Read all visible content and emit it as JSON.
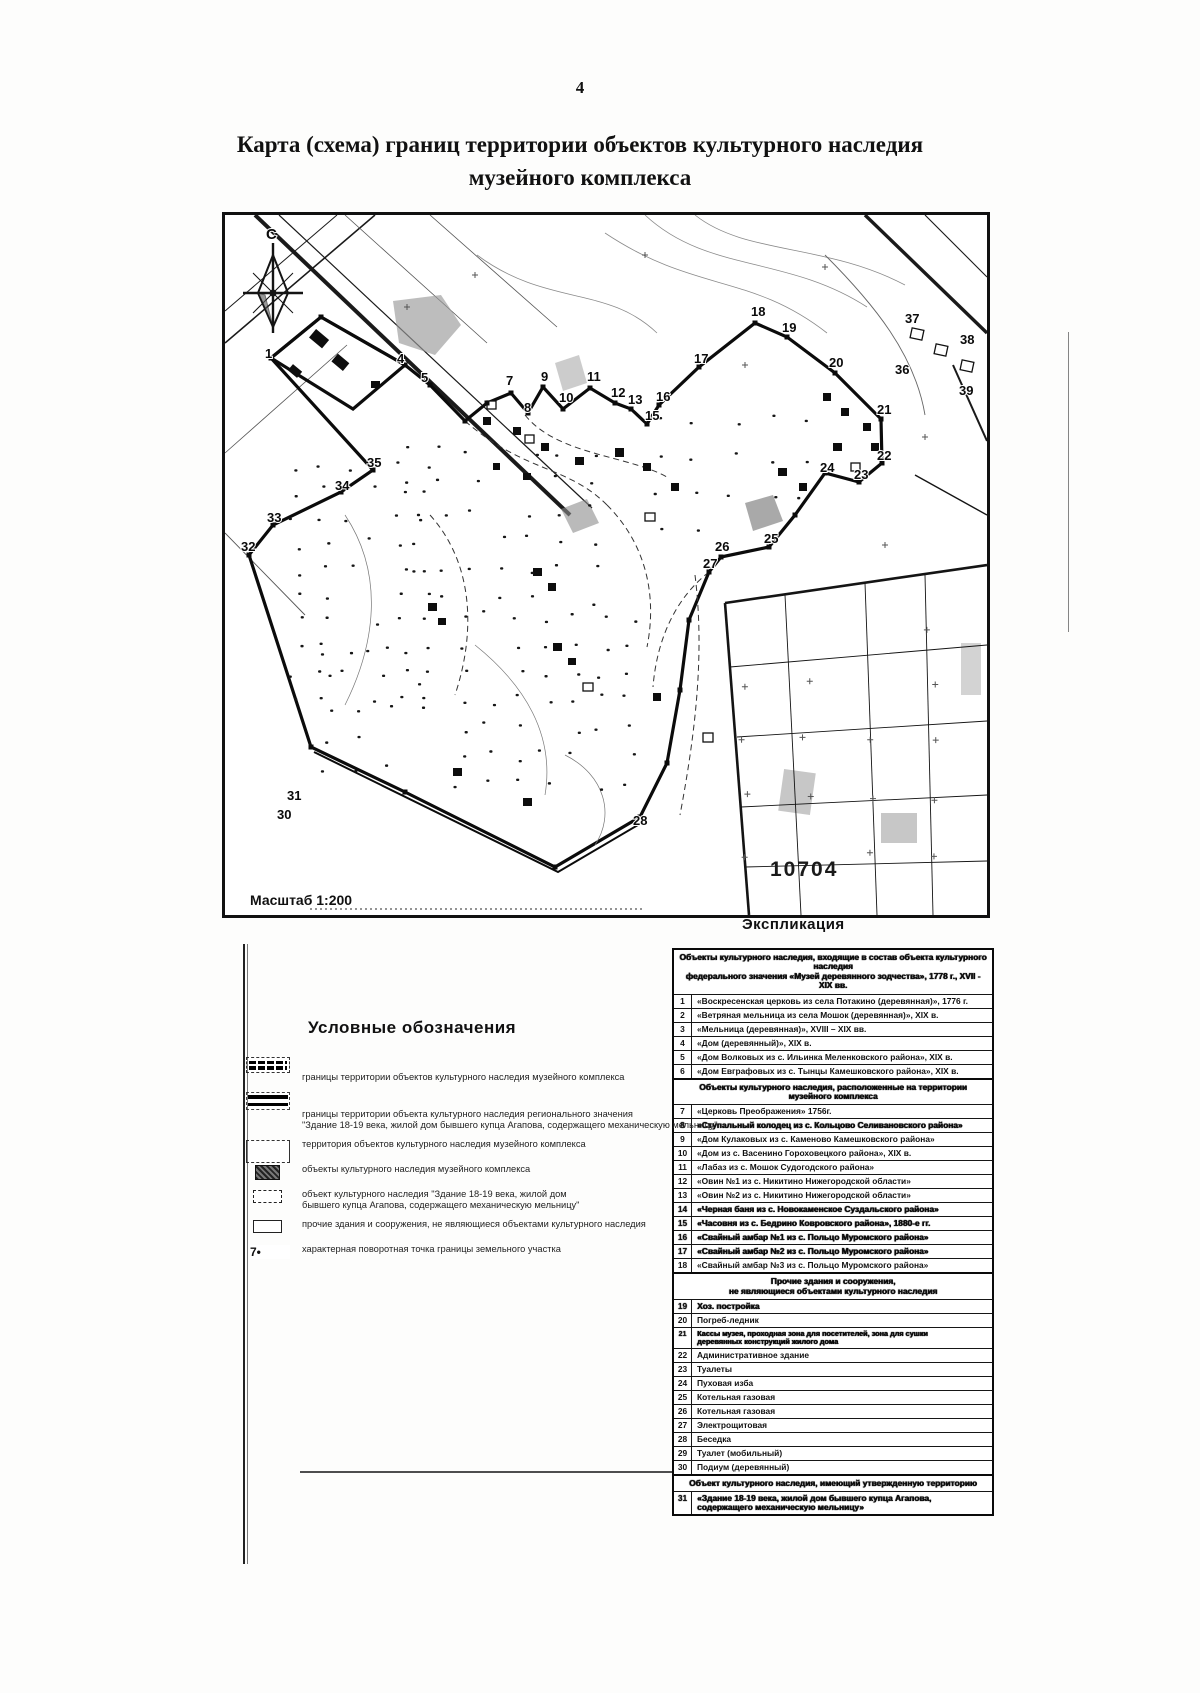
{
  "page": {
    "number": "4",
    "title": "Карта (схема) границ территории объектов культурного наследия\nмузейного комплекса"
  },
  "map": {
    "compass_label": "С",
    "scale_label": "Масштаб 1:200",
    "parcel_number": "10704",
    "points": [
      {
        "n": "1",
        "x": 40,
        "y": 143
      },
      {
        "n": "4",
        "x": 172,
        "y": 148
      },
      {
        "n": "5",
        "x": 196,
        "y": 167
      },
      {
        "n": "7",
        "x": 281,
        "y": 170
      },
      {
        "n": "8",
        "x": 299,
        "y": 197
      },
      {
        "n": "9",
        "x": 316,
        "y": 166
      },
      {
        "n": "10",
        "x": 334,
        "y": 187
      },
      {
        "n": "11",
        "x": 362,
        "y": 166
      },
      {
        "n": "12",
        "x": 386,
        "y": 182
      },
      {
        "n": "13",
        "x": 403,
        "y": 189
      },
      {
        "n": "15",
        "x": 420,
        "y": 205
      },
      {
        "n": "16",
        "x": 431,
        "y": 186
      },
      {
        "n": "17",
        "x": 469,
        "y": 148
      },
      {
        "n": "18",
        "x": 526,
        "y": 101
      },
      {
        "n": "19",
        "x": 557,
        "y": 117
      },
      {
        "n": "20",
        "x": 604,
        "y": 152
      },
      {
        "n": "21",
        "x": 652,
        "y": 199
      },
      {
        "n": "22",
        "x": 652,
        "y": 245
      },
      {
        "n": "23",
        "x": 629,
        "y": 264
      },
      {
        "n": "24",
        "x": 595,
        "y": 257
      },
      {
        "n": "25",
        "x": 539,
        "y": 328
      },
      {
        "n": "26",
        "x": 490,
        "y": 336
      },
      {
        "n": "27",
        "x": 478,
        "y": 353
      },
      {
        "n": "28",
        "x": 408,
        "y": 610
      },
      {
        "n": "30",
        "x": 52,
        "y": 604
      },
      {
        "n": "31",
        "x": 62,
        "y": 585
      },
      {
        "n": "32",
        "x": 16,
        "y": 336
      },
      {
        "n": "33",
        "x": 42,
        "y": 307
      },
      {
        "n": "34",
        "x": 110,
        "y": 275
      },
      {
        "n": "35",
        "x": 142,
        "y": 252
      },
      {
        "n": "36",
        "x": 670,
        "y": 159
      },
      {
        "n": "37",
        "x": 680,
        "y": 108
      },
      {
        "n": "38",
        "x": 735,
        "y": 129
      },
      {
        "n": "39",
        "x": 734,
        "y": 180
      }
    ]
  },
  "legend": {
    "title": "Условные обозначения",
    "items": [
      {
        "sym": "dashed-box",
        "text": "границы территории объектов культурного наследия музейного комплекса"
      },
      {
        "sym": "double-line-box",
        "text": "границы территории объекта культурного наследия регионального значения\n\"Здание 18-19 века, жилой дом бывшего купца Агапова, содержащего механическую мельницу\""
      },
      {
        "sym": "open-box",
        "text": "территория объектов культурного наследия музейного комплекса"
      },
      {
        "sym": "hatched-box",
        "text": "объекты культурного наследия музейного комплекса"
      },
      {
        "sym": "dashed-small-box",
        "text": "объект культурного наследия \"Здание 18-19 века, жилой дом\nбывшего купца Агапова, содержащего механическую мельницу\""
      },
      {
        "sym": "open-small-box",
        "text": "прочие здания и сооружения, не являющиеся объектами культурного наследия"
      },
      {
        "sym": "point",
        "symbol_text": "7•",
        "text": "характерная поворотная точка границы земельного участка"
      }
    ]
  },
  "explication": {
    "title": "Экспликация",
    "sections": [
      {
        "header": "Объекты культурного наследия, входящие в состав объекта культурного наследия\nфедерального значения «Музей деревянного зодчества», 1778 г., XVII - XIX вв.",
        "rows": [
          {
            "n": "1",
            "text": "«Воскресенская церковь из села Потакино (деревянная)», 1776 г."
          },
          {
            "n": "2",
            "text": "«Ветряная мельница из села Мошок (деревянная)», XIX в."
          },
          {
            "n": "3",
            "text": "«Мельница (деревянная)», XVIII – XIX вв."
          },
          {
            "n": "4",
            "text": "«Дом (деревянный)», XIX в."
          },
          {
            "n": "5",
            "text": "«Дом Волковых из с. Ильинка Меленковского района», XIX в."
          },
          {
            "n": "6",
            "text": "«Дом Евграфовых из с. Тынцы Камешковского района», XIX в."
          }
        ]
      },
      {
        "header": "Объекты культурного наследия, расположенные на территории музейного комплекса",
        "rows": [
          {
            "n": "7",
            "text": "«Церковь Преображения» 1756г."
          },
          {
            "n": "8",
            "heavy": true,
            "text": "«Ступальный колодец из с. Кольцово Селивановского района»"
          },
          {
            "n": "9",
            "text": "«Дом Кулаковых из с. Каменово Камешковского района»"
          },
          {
            "n": "10",
            "text": "«Дом из с. Васенино Гороховецкого района», XIX в."
          },
          {
            "n": "11",
            "text": "«Лабаз из с. Мошок Судогодского района»"
          },
          {
            "n": "12",
            "text": "«Овин №1 из с. Никитино Нижегородской области»"
          },
          {
            "n": "13",
            "text": "«Овин №2 из с. Никитино Нижегородской области»"
          },
          {
            "n": "14",
            "heavy": true,
            "text": "«Черная баня из с. Новокаменское Суздальского района»"
          },
          {
            "n": "15",
            "heavy": true,
            "text": "«Часовня из с. Бедрино Ковровского района», 1880-е гг."
          },
          {
            "n": "16",
            "heavy": true,
            "text": "«Свайный амбар №1 из с. Польцо Муромского района»"
          },
          {
            "n": "17",
            "heavy": true,
            "text": "«Свайный амбар №2 из с. Польцо Муромского района»"
          },
          {
            "n": "18",
            "text": "«Свайный амбар №3 из с. Польцо Муромского района»"
          }
        ]
      },
      {
        "header": "Прочие здания и сооружения,\nне являющиеся объектами культурного наследия",
        "rows": [
          {
            "n": "19",
            "heavy": true,
            "text": "Хоз. постройка"
          },
          {
            "n": "20",
            "text": "Погреб-ледник"
          },
          {
            "n": "21",
            "small": true,
            "heavy": true,
            "text": "Кассы музея, проходная зона для посетителей, зона для сушки\nдеревянных конструкций жилого дома"
          },
          {
            "n": "22",
            "text": "Административное здание"
          },
          {
            "n": "23",
            "text": "Туалеты"
          },
          {
            "n": "24",
            "text": "Пуховая изба"
          },
          {
            "n": "25",
            "text": "Котельная газовая"
          },
          {
            "n": "26",
            "text": "Котельная газовая"
          },
          {
            "n": "27",
            "text": "Электрощитовая"
          },
          {
            "n": "28",
            "text": "Беседка"
          },
          {
            "n": "29",
            "text": "Туалет (мобильный)"
          },
          {
            "n": "30",
            "text": "Подиум (деревянный)"
          }
        ]
      },
      {
        "header": "Объект культурного наследия, имеющий утвержденную территорию",
        "rows": [
          {
            "n": "31",
            "heavy": true,
            "text": "«Здание 18-19 века, жилой дом бывшего купца Агапова,\nсодержащего механическую мельницу»"
          }
        ]
      }
    ]
  }
}
